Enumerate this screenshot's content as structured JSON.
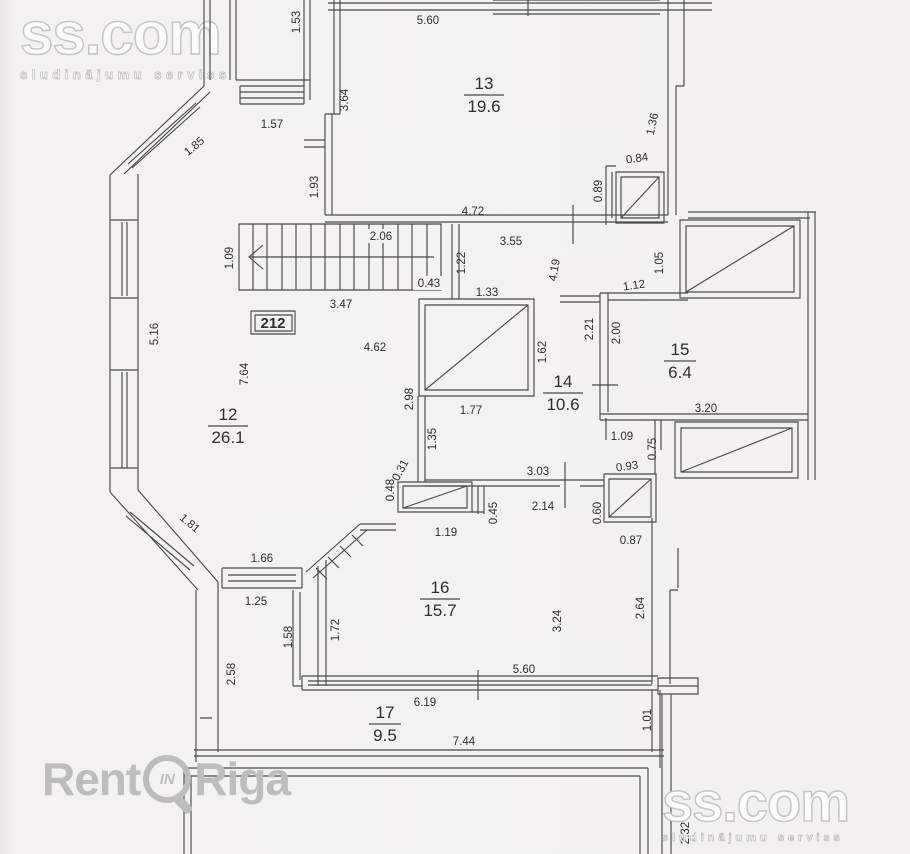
{
  "watermarks": {
    "ss_top": {
      "title": "ss.com",
      "subtitle": "sludinājumu serviss"
    },
    "ss_bottom": {
      "title": "ss.com",
      "subtitle": "sludinājumu serviss"
    },
    "rentinriga": {
      "part1": "Rent",
      "badge": "IN",
      "part2": "Riga"
    }
  },
  "plan": {
    "apartment_label": "212",
    "rooms": [
      {
        "number": "13",
        "area": "19.6",
        "x": 484,
        "y": 95,
        "line_w": 40
      },
      {
        "number": "12",
        "area": "26.1",
        "x": 228,
        "y": 426,
        "line_w": 40
      },
      {
        "number": "14",
        "area": "10.6",
        "x": 563,
        "y": 393,
        "line_w": 40
      },
      {
        "number": "15",
        "area": "6.4",
        "x": 680,
        "y": 361,
        "line_w": 32
      },
      {
        "number": "16",
        "area": "15.7",
        "x": 440,
        "y": 599,
        "line_w": 40
      },
      {
        "number": "17",
        "area": "9.5",
        "x": 385,
        "y": 724,
        "line_w": 32
      }
    ],
    "dimensions": [
      {
        "text": "1.53",
        "x": 296,
        "y": 22,
        "r": -90
      },
      {
        "text": "5.60",
        "x": 428,
        "y": 20,
        "r": 0
      },
      {
        "text": "3.64",
        "x": 344,
        "y": 100,
        "r": -90
      },
      {
        "text": "1.57",
        "x": 272,
        "y": 124,
        "r": 0
      },
      {
        "text": "1.85",
        "x": 194,
        "y": 146,
        "r": -40
      },
      {
        "text": "1.36",
        "x": 652,
        "y": 124,
        "r": -78
      },
      {
        "text": "0.84",
        "x": 637,
        "y": 158,
        "r": -8
      },
      {
        "text": "0.89",
        "x": 598,
        "y": 191,
        "r": -90
      },
      {
        "text": "1.93",
        "x": 314,
        "y": 187,
        "r": -90
      },
      {
        "text": "4.72",
        "x": 473,
        "y": 211,
        "r": 0
      },
      {
        "text": "2.06",
        "x": 381,
        "y": 236,
        "r": 0,
        "bg": 1
      },
      {
        "text": "3.55",
        "x": 511,
        "y": 241,
        "r": 0
      },
      {
        "text": "1.09",
        "x": 229,
        "y": 258,
        "r": -90
      },
      {
        "text": "1.22",
        "x": 461,
        "y": 263,
        "r": -90
      },
      {
        "text": "4.19",
        "x": 554,
        "y": 270,
        "r": -80
      },
      {
        "text": "1.05",
        "x": 659,
        "y": 263,
        "r": -90
      },
      {
        "text": "0.43",
        "x": 429,
        "y": 283,
        "r": 0,
        "bg": 1
      },
      {
        "text": "1.12",
        "x": 634,
        "y": 285,
        "r": -8
      },
      {
        "text": "1.33",
        "x": 487,
        "y": 292,
        "r": 0
      },
      {
        "text": "3.47",
        "x": 341,
        "y": 304,
        "r": 0
      },
      {
        "text": "2.21",
        "x": 589,
        "y": 329,
        "r": -90
      },
      {
        "text": "2.00",
        "x": 616,
        "y": 333,
        "r": -90
      },
      {
        "text": "5.16",
        "x": 154,
        "y": 334,
        "r": -90
      },
      {
        "text": "4.62",
        "x": 375,
        "y": 347,
        "r": 0
      },
      {
        "text": "1.62",
        "x": 542,
        "y": 352,
        "r": -90
      },
      {
        "text": "7.64",
        "x": 244,
        "y": 374,
        "r": -90
      },
      {
        "text": "2.98",
        "x": 409,
        "y": 399,
        "r": -90
      },
      {
        "text": "3.20",
        "x": 706,
        "y": 408,
        "r": 0
      },
      {
        "text": "1.77",
        "x": 471,
        "y": 410,
        "r": 0
      },
      {
        "text": "1.09",
        "x": 622,
        "y": 436,
        "r": 0
      },
      {
        "text": "1.35",
        "x": 432,
        "y": 439,
        "r": -90
      },
      {
        "text": "0.75",
        "x": 652,
        "y": 449,
        "r": -90
      },
      {
        "text": "0.93",
        "x": 627,
        "y": 466,
        "r": -8
      },
      {
        "text": "0.31",
        "x": 400,
        "y": 470,
        "r": -62
      },
      {
        "text": "3.03",
        "x": 538,
        "y": 471,
        "r": 0
      },
      {
        "text": "0.48",
        "x": 390,
        "y": 490,
        "r": -90
      },
      {
        "text": "2.14",
        "x": 543,
        "y": 506,
        "r": 0
      },
      {
        "text": "0.45",
        "x": 493,
        "y": 513,
        "r": -90
      },
      {
        "text": "0.60",
        "x": 597,
        "y": 513,
        "r": -90
      },
      {
        "text": "1.81",
        "x": 190,
        "y": 523,
        "r": 40
      },
      {
        "text": "1.19",
        "x": 446,
        "y": 532,
        "r": 0
      },
      {
        "text": "0.87",
        "x": 631,
        "y": 540,
        "r": 0
      },
      {
        "text": "1.66",
        "x": 262,
        "y": 558,
        "r": 0
      },
      {
        "text": "1.25",
        "x": 256,
        "y": 601,
        "r": 0
      },
      {
        "text": "1.58",
        "x": 288,
        "y": 637,
        "r": -90
      },
      {
        "text": "1.72",
        "x": 335,
        "y": 630,
        "r": -90
      },
      {
        "text": "3.24",
        "x": 557,
        "y": 621,
        "r": -90
      },
      {
        "text": "2.64",
        "x": 640,
        "y": 608,
        "r": -90
      },
      {
        "text": "5.60",
        "x": 524,
        "y": 669,
        "r": 0
      },
      {
        "text": "2.58",
        "x": 231,
        "y": 674,
        "r": -90
      },
      {
        "text": "6.19",
        "x": 425,
        "y": 702,
        "r": 0
      },
      {
        "text": "1.01",
        "x": 647,
        "y": 720,
        "r": -90
      },
      {
        "text": "7.44",
        "x": 464,
        "y": 741,
        "r": 0
      },
      {
        "text": "2.32",
        "x": 685,
        "y": 833,
        "r": -90
      }
    ]
  },
  "colors": {
    "paper": "#f2f1ef",
    "line": "#4a4a4a",
    "dim_text": "#2e2e2e",
    "watermark_gray": "#bdbdbd"
  }
}
